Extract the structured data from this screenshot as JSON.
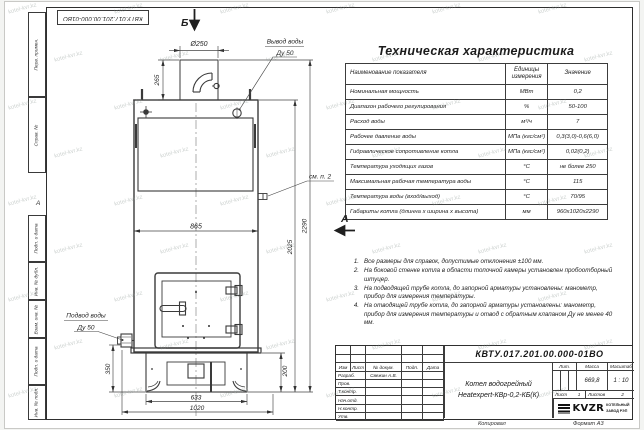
{
  "watermark": "kotel-kvr.kz",
  "frame": {
    "doc_number_top": "КВТУ.017.201.00.000-01ВО",
    "zone_letter": "А",
    "margin_boxes_top": [
      "Перв. примен.",
      "Справ. №"
    ],
    "margin_boxes_bottom": [
      "Подп. и дата",
      "Инв. № дубл.",
      "Взам. инв. №",
      "Подп. и дата",
      "Инв. № подл."
    ]
  },
  "drawing": {
    "view_top": "Б",
    "view_side": "А",
    "labels": {
      "outlet_1": "Вывод воды",
      "outlet_2": "Ду 50",
      "inlet_1": "Подвод воды",
      "inlet_2": "Ду 50",
      "callout": "см. п. 2"
    },
    "dims": {
      "diameter": "Ø250",
      "chimney": "265",
      "width": "865",
      "height_body": "2025",
      "height_total": "2290",
      "inlet": "350",
      "base_h": "200",
      "base_w": "633",
      "depth": "1020"
    }
  },
  "spec_table": {
    "title": "Техническая характеристика",
    "headers": [
      "Наименование показателя",
      "Единицы измерения",
      "Значение"
    ],
    "rows": [
      [
        "Номинальная мощность",
        "МВт",
        "0,2"
      ],
      [
        "Диапазон рабочего регулирования",
        "%",
        "50-100"
      ],
      [
        "Расход воды",
        "м³/ч",
        "7"
      ],
      [
        "Рабочее давление воды",
        "МПа (кгс/см²)",
        "0,3(3,0)-0,6(6,0)"
      ],
      [
        "Гидравлическое сопротивление котла",
        "МПа (кгс/см²)",
        "0,02(0,2)"
      ],
      [
        "Температура уходящих газов",
        "°С",
        "не более 250"
      ],
      [
        "Максимальная рабочая температура воды",
        "°С",
        "115"
      ],
      [
        "Температура воды (вход/выход)",
        "°С",
        "70/95"
      ],
      [
        "Габариты котла (длинна х ширина х высота)",
        "мм",
        "960х1020х2290"
      ]
    ]
  },
  "notes": [
    "Все размеры для справок, допустимые отклонения ±100 мм.",
    "На боковой стенке котла в области топочной камеры установлен пробоотборный штуцер.",
    "На подводящей трубе котла, до запорной арматуры установлены: манометр, прибор для измерения температуры.",
    "На отводящей трубе котла, до запорной арматуры установлены: манометр, прибор для измерения температуры и отвод с обратным клапаном Ду не менее 40 мм."
  ],
  "title_block": {
    "doc_number": "КВТУ.017.201.00.000-01ВО",
    "product_name_1": "Котел водогрейный",
    "product_name_2": "Heatexpert-КВр-0,2-КБ(К)",
    "header_cols": [
      "Изм",
      "Лист",
      "№ докум.",
      "Подп.",
      "Дата"
    ],
    "sign_rows": [
      {
        "label": "Разраб.",
        "name": "Свежин А.В."
      },
      {
        "label": "Пров.",
        "name": ""
      },
      {
        "label": "Т.контр.",
        "name": ""
      },
      {
        "label": "Нач.отд.",
        "name": ""
      },
      {
        "label": "Н.контр.",
        "name": ""
      },
      {
        "label": "Утв.",
        "name": ""
      }
    ],
    "lit_label": "Лит.",
    "mass_label": "Масса",
    "scale_label": "Масштаб",
    "mass": "669,8",
    "scale": "1 : 10",
    "sheet_label": "Лист",
    "sheet": "1",
    "sheets_label": "Листов",
    "sheets": "2",
    "company": {
      "logo": "KVZR",
      "line1": "КОТЕЛЬНЫЙ",
      "line2": "ЗАВОД РЭП"
    }
  },
  "footer": {
    "copied": "Копировал",
    "format": "Формат А3"
  }
}
